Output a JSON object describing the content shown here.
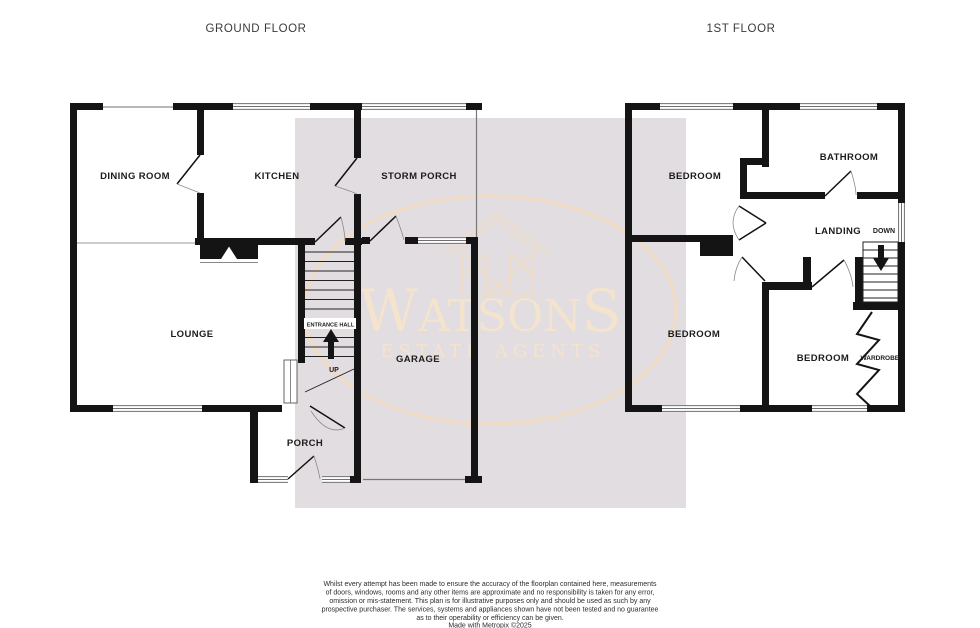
{
  "floorplan": {
    "ground_floor": {
      "title": "GROUND FLOOR",
      "rooms": {
        "dining_room": "DINING ROOM",
        "kitchen": "KITCHEN",
        "storm_porch": "STORM PORCH",
        "lounge": "LOUNGE",
        "entrance_hall": "ENTRANCE HALL",
        "garage": "GARAGE",
        "porch": "PORCH"
      },
      "stair_label": "UP"
    },
    "first_floor": {
      "title": "1ST FLOOR",
      "rooms": {
        "bedroom_front": "BEDROOM",
        "bathroom": "BATHROOM",
        "landing": "LANDING",
        "bedroom_back": "BEDROOM",
        "bedroom_third": "BEDROOM",
        "wardrobe": "WARDROBE"
      },
      "stair_label": "DOWN"
    }
  },
  "watermark": {
    "brand_w": "W",
    "brand_mid": "ATSON",
    "brand_s": "S",
    "tagline": "ESTATE AGENTS",
    "colors": {
      "panel": "#e2dde1",
      "logo_text": "#f4e3cd",
      "logo_outline": "#f2dcc3"
    }
  },
  "disclaimer": {
    "lines": [
      "Whilst every attempt has been made to ensure the accuracy of the floorplan contained here, measurements",
      "of doors, windows, rooms and any other items are approximate and no responsibility is taken for any error,",
      "omission or mis-statement. This plan is for illustrative purposes only and should be used as such by any",
      "prospective purchaser. The services, systems and appliances shown have not been tested and no guarantee",
      "as to their operability or efficiency can be given.",
      "Made with Metropix ©2025"
    ]
  },
  "colors": {
    "wall": "#141414",
    "background": "#ffffff",
    "label": "#1c1c1c"
  }
}
